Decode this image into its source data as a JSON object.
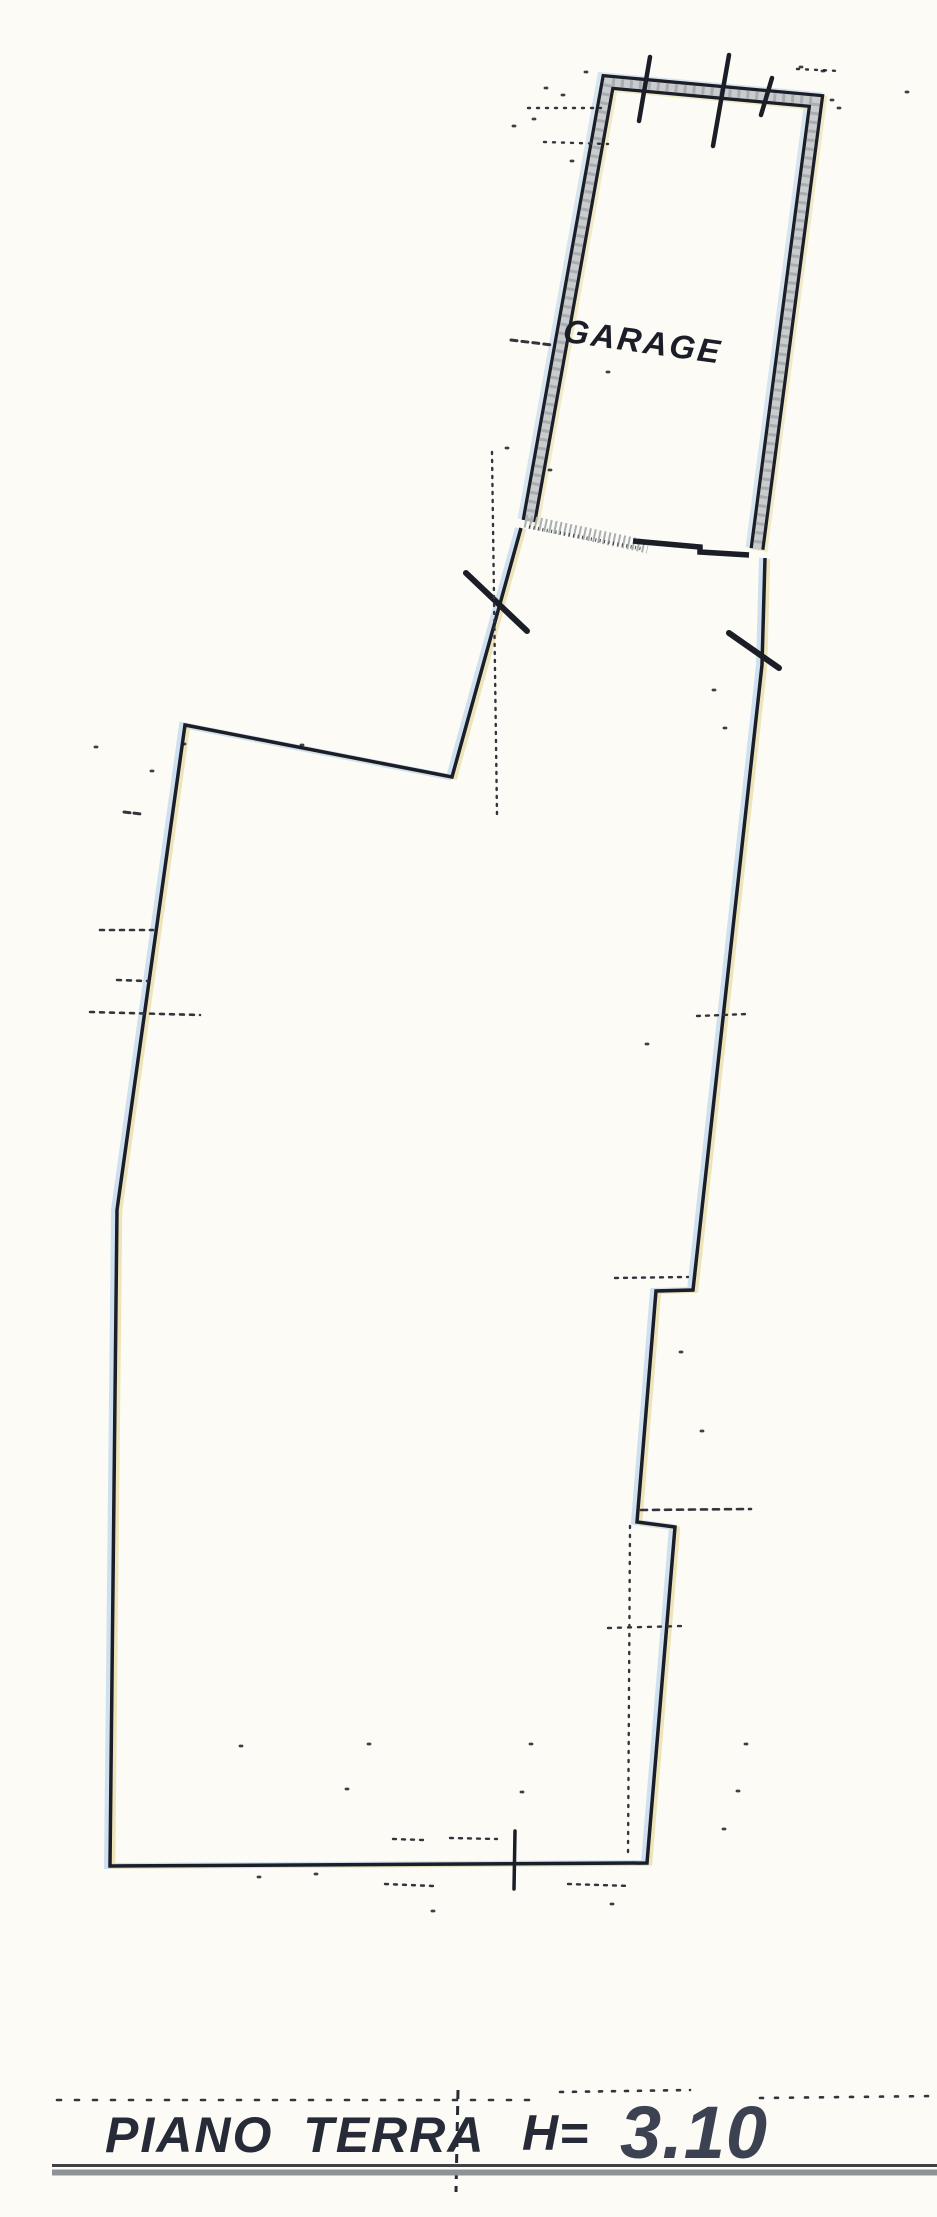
{
  "labels": {
    "room": "GARAGE",
    "floor": "PIANO TERRA",
    "height_prefix": "H=",
    "height_value": "3.10"
  },
  "colors": {
    "paper": "#fcfbf6",
    "ink": "#1b1d27",
    "wall_core_grey": "#c9cccd",
    "wall_speckle_grey": "#9da2a5",
    "door_stipple_grey": "#a9aeb1",
    "footer_rule_dark": "#3e4146",
    "footer_rule_grey": "#8f9396",
    "text_dark": "#262b37",
    "height_value_grey": "#3c4252",
    "scan_fringe_blue": "#c7dcee",
    "scan_fringe_yellow": "#eadfab",
    "dotted_marks": "#33343e"
  }
}
